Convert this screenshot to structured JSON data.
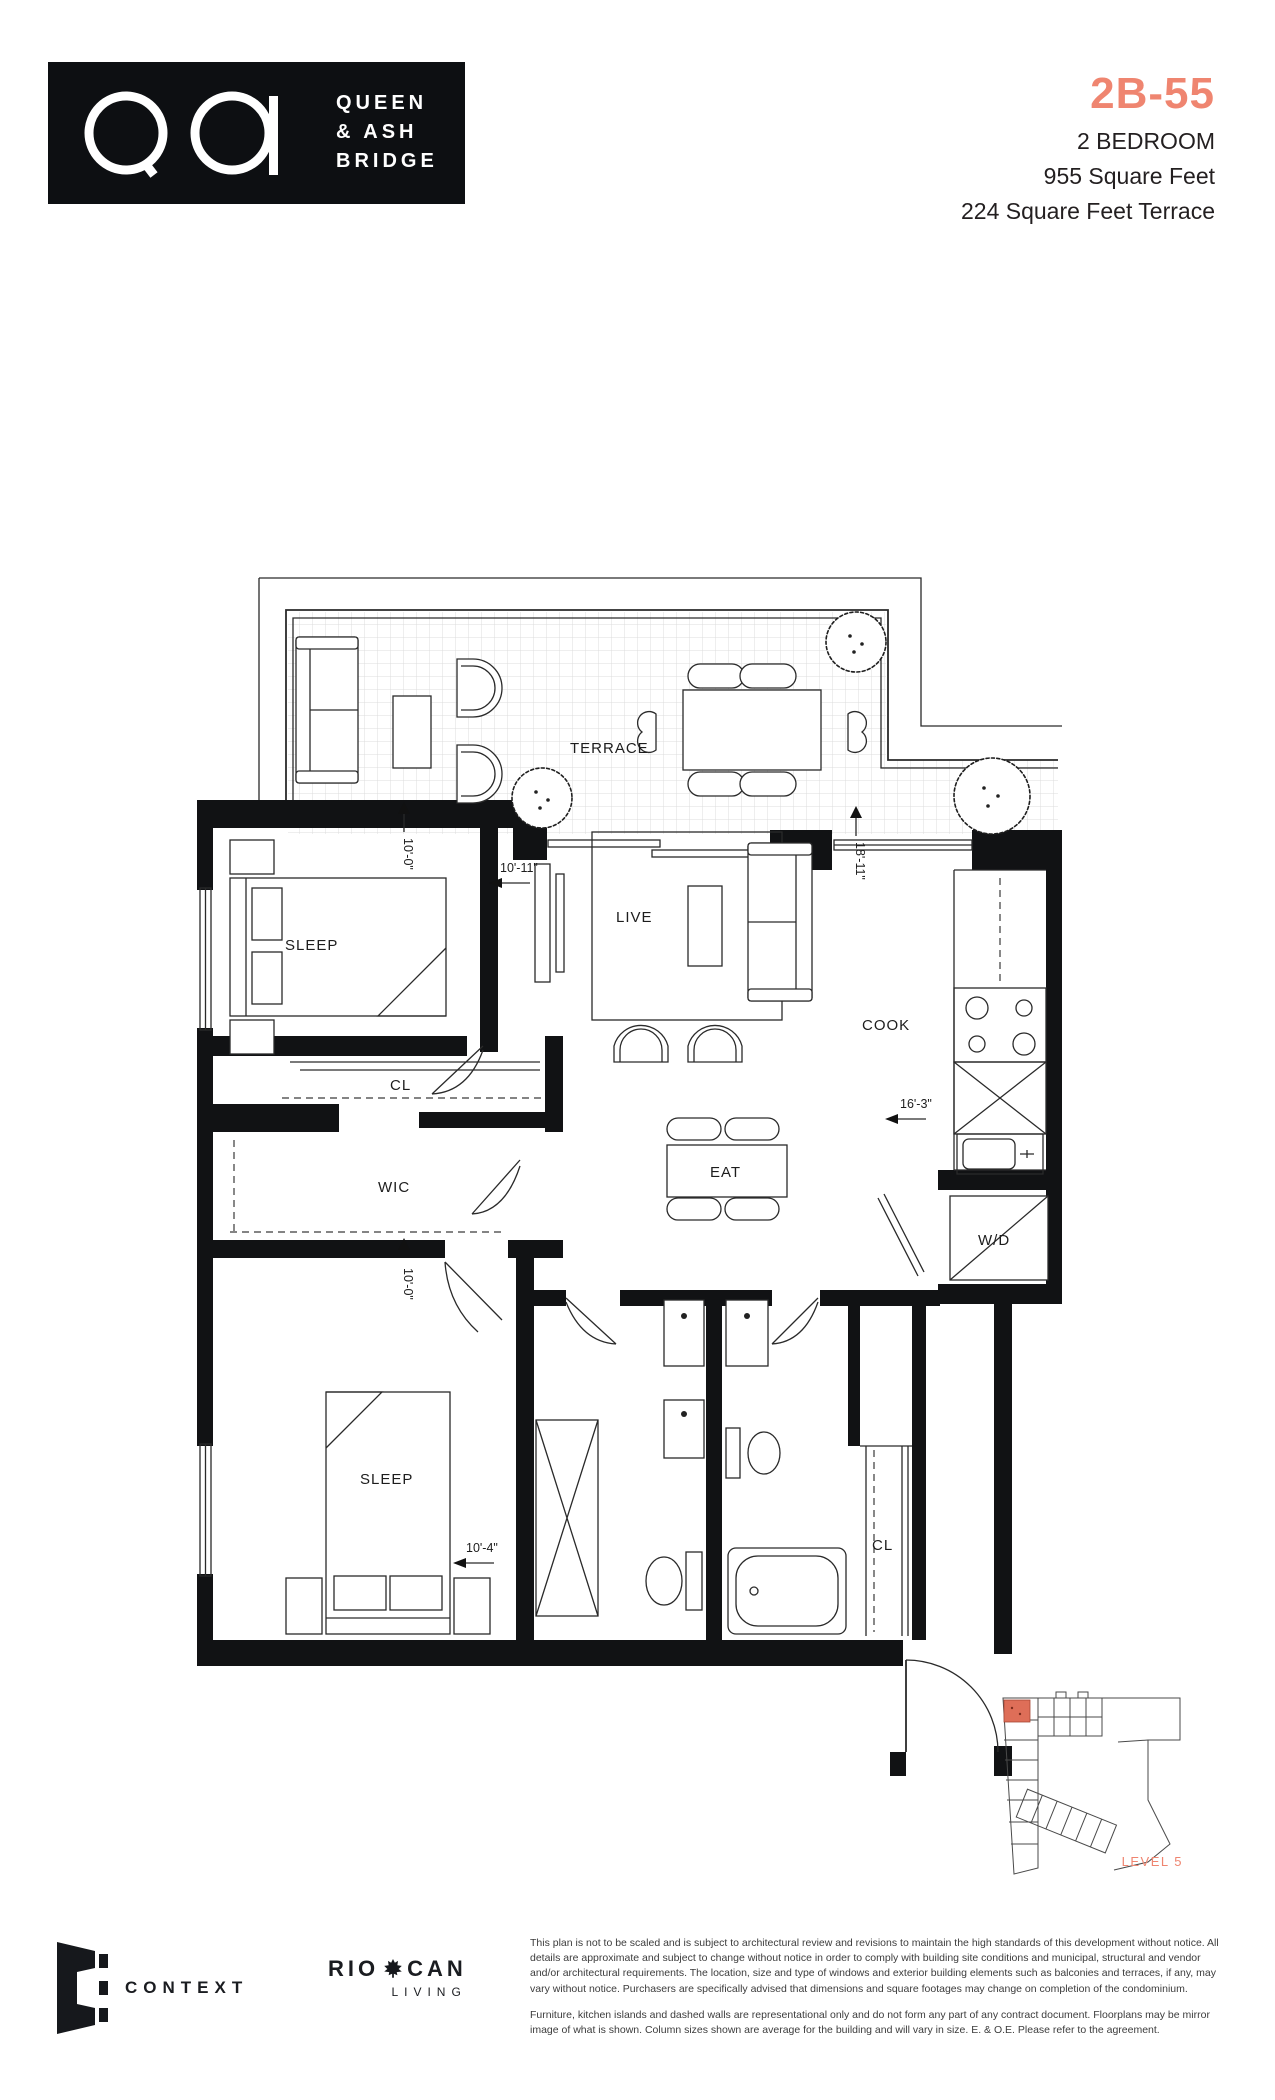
{
  "header": {
    "logo": {
      "line1": "QUEEN",
      "line2": "& ASH",
      "line3": "BRIDGE"
    },
    "unit_number": "2B-55",
    "unit_type": "2 BEDROOM",
    "area": "955 Square Feet",
    "terrace_area": "224 Square Feet Terrace"
  },
  "plan": {
    "labels": {
      "terrace": "TERRACE",
      "sleep1": "SLEEP",
      "live": "LIVE",
      "cook": "COOK",
      "eat": "EAT",
      "cl1": "CL",
      "wic": "WIC",
      "sleep2": "SLEEP",
      "cl2": "CL",
      "wd": "W/D"
    },
    "dimensions": {
      "sleep1_width": "10'-0\"",
      "live_width": "10'-11\"",
      "main_depth": "18'-11\"",
      "cook_depth": "16'-3\"",
      "sleep2_width": "10'-0\"",
      "sleep2_depth": "10'-4\""
    }
  },
  "keyplan": {
    "level_label": "LEVEL 5"
  },
  "footer": {
    "context_label": "CONTEXT",
    "riocan_rio": "RIO",
    "riocan_can": "CAN",
    "riocan_living": "LIVING",
    "disclaimer_p1": "This plan is not to be scaled and is subject to architectural review and revisions to maintain the high standards of this development without notice. All details are approximate and subject to change without notice in order to comply with building site conditions and municipal, structural and vendor and/or architectural requirements. The location, size and type of windows and exterior building elements such as balconies and terraces, if any, may vary without notice. Purchasers are specifically advised that dimensions and square footages may change on completion of the condominium.",
    "disclaimer_p2": "Furniture, kitchen islands and dashed walls are representational only and do not form any part of any contract document. Floorplans may be mirror image of what is shown. Column sizes shown are average for the building and will vary in size. E. & O.E. Please refer to the agreement."
  },
  "colors": {
    "accent": "#EF8570",
    "ink": "#231F20",
    "keyplan_unit": "#DE6E58"
  }
}
